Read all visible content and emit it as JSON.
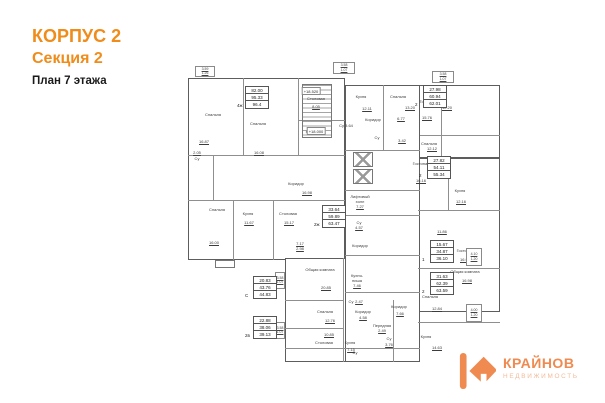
{
  "header": {
    "building": "КОРПУС 2",
    "section": "Секция 2",
    "plan_title": "План 7 этажа"
  },
  "logo": {
    "name": "КРАЙНОВ",
    "subtitle": "НЕДВИЖИМОСТЬ"
  },
  "colors": {
    "accent_orange": "#ef8c1a",
    "logo_orange": "#ef8a50",
    "logo_light": "#f3bb98",
    "wall_gray": "#5d5d5d"
  },
  "plan": {
    "elevations": [
      {
        "t": "+18.520",
        "x": 128,
        "y": 31
      },
      {
        "t": "+18.000",
        "x": 133,
        "y": 71
      }
    ],
    "apartments": [
      {
        "x": 62,
        "y": 26,
        "type": "4ж",
        "rows": [
          "82.00",
          "95.33",
          "96.4"
        ]
      },
      {
        "x": 240,
        "y": 25,
        "type": "2",
        "rows": [
          "27.98",
          "60.94",
          "62.01"
        ]
      },
      {
        "x": 244,
        "y": 96,
        "type": "2",
        "rows": [
          "27.82",
          "54.11",
          "55.34"
        ]
      },
      {
        "x": 247,
        "y": 180,
        "type": "1",
        "rows": [
          "15.67",
          "34.87",
          "36.10"
        ]
      },
      {
        "x": 247,
        "y": 212,
        "type": "2",
        "rows": [
          "31.63",
          "62.39",
          "63.59"
        ]
      },
      {
        "x": 139,
        "y": 145,
        "type": "2ж",
        "rows": [
          "33.64",
          "59.89",
          "63.47"
        ]
      },
      {
        "x": 70,
        "y": 216,
        "type": "С",
        "rows": [
          "20.83",
          "43.76",
          "44.83"
        ]
      },
      {
        "x": 70,
        "y": 256,
        "type": "2в",
        "rows": [
          "22.88",
          "38.06",
          "39.13"
        ]
      }
    ],
    "balconies": [
      {
        "x": 12,
        "y": 6,
        "w": 20,
        "h": 11,
        "a": "3.59",
        "b": "1.26"
      },
      {
        "x": 150,
        "y": 2,
        "w": 22,
        "h": 12,
        "a": "3.58",
        "b": "1.07"
      },
      {
        "x": 249,
        "y": 11,
        "w": 22,
        "h": 12,
        "a": "3.58",
        "b": "1.07"
      },
      {
        "x": 283,
        "y": 188,
        "w": 16,
        "h": 18,
        "a": "4.10",
        "b": "1.20"
      },
      {
        "x": 283,
        "y": 244,
        "w": 16,
        "h": 18,
        "a": "4.00",
        "b": "1.20"
      },
      {
        "x": 92,
        "y": 212,
        "w": 10,
        "h": 17,
        "a": "3.58",
        "b": "1.07"
      },
      {
        "x": 92,
        "y": 262,
        "w": 10,
        "h": 17,
        "a": "3.58",
        "b": "1.07"
      }
    ],
    "labels": [
      {
        "t": "Спальня",
        "x": 30,
        "y": 55
      },
      {
        "t": "16.87",
        "x": 21,
        "y": 82
      },
      {
        "t": "Спальня",
        "x": 75,
        "y": 64
      },
      {
        "t": "16.08",
        "x": 76,
        "y": 93
      },
      {
        "t": "Столовая",
        "x": 133,
        "y": 39
      },
      {
        "t": "8.05",
        "x": 133,
        "y": 47
      },
      {
        "t": "Кухня",
        "x": 128,
        "y": 72
      },
      {
        "t": "2.05",
        "x": 14,
        "y": 93
      },
      {
        "t": "Су",
        "x": 14,
        "y": 99
      },
      {
        "t": "Коридор",
        "x": 113,
        "y": 124
      },
      {
        "t": "16.98",
        "x": 124,
        "y": 133
      },
      {
        "t": "Спальня",
        "x": 34,
        "y": 150
      },
      {
        "t": "16.00",
        "x": 31,
        "y": 183
      },
      {
        "t": "Кухня",
        "x": 65,
        "y": 154
      },
      {
        "t": "11.67",
        "x": 66,
        "y": 163
      },
      {
        "t": "Столовая",
        "x": 105,
        "y": 154
      },
      {
        "t": "15.17",
        "x": 106,
        "y": 163
      },
      {
        "t": "7.17",
        "x": 117,
        "y": 184
      },
      {
        "t": "2.98",
        "x": 117,
        "y": 189
      },
      {
        "t": "Кухня",
        "x": 178,
        "y": 37
      },
      {
        "t": "12.11",
        "x": 184,
        "y": 49
      },
      {
        "t": "Спальня",
        "x": 215,
        "y": 37
      },
      {
        "t": "13.20",
        "x": 227,
        "y": 48
      },
      {
        "t": "12.20",
        "x": 264,
        "y": 48
      },
      {
        "t": "Коридор",
        "x": 190,
        "y": 60
      },
      {
        "t": "Су 3.64",
        "x": 163,
        "y": 66
      },
      {
        "t": "6.77",
        "x": 218,
        "y": 59
      },
      {
        "t": "Гостиная",
        "x": 245,
        "y": 42
      },
      {
        "t": "15.76",
        "x": 244,
        "y": 58
      },
      {
        "t": "Су",
        "x": 194,
        "y": 78
      },
      {
        "t": "3.42",
        "x": 219,
        "y": 81
      },
      {
        "t": "Спальня",
        "x": 246,
        "y": 84
      },
      {
        "t": "12.12",
        "x": 249,
        "y": 89
      },
      {
        "t": "Гостиная",
        "x": 238,
        "y": 104
      },
      {
        "t": "16.16",
        "x": 238,
        "y": 121
      },
      {
        "t": "Кухня",
        "x": 277,
        "y": 131
      },
      {
        "t": "12.16",
        "x": 278,
        "y": 142
      },
      {
        "t": "11.86",
        "x": 259,
        "y": 172
      },
      {
        "t": "Гостиная",
        "x": 282,
        "y": 191
      },
      {
        "t": "16.96",
        "x": 282,
        "y": 200
      },
      {
        "t": "Общая комната",
        "x": 282,
        "y": 212
      },
      {
        "t": "16.98",
        "x": 284,
        "y": 221
      },
      {
        "t": "Спальня",
        "x": 247,
        "y": 237
      },
      {
        "t": "12.84",
        "x": 254,
        "y": 249
      },
      {
        "t": "Кухня",
        "x": 243,
        "y": 277
      },
      {
        "t": "14.63",
        "x": 254,
        "y": 288
      },
      {
        "t": "Лифтовый",
        "x": 177,
        "y": 137
      },
      {
        "t": "холл",
        "x": 177,
        "y": 142
      },
      {
        "t": "7.27",
        "x": 177,
        "y": 147
      },
      {
        "t": "Су",
        "x": 176,
        "y": 163
      },
      {
        "t": "4.57",
        "x": 176,
        "y": 168
      },
      {
        "t": "Коридор",
        "x": 177,
        "y": 186
      },
      {
        "t": "Общая комната",
        "x": 137,
        "y": 210
      },
      {
        "t": "20.85",
        "x": 143,
        "y": 228
      },
      {
        "t": "Кухня-",
        "x": 174,
        "y": 216
      },
      {
        "t": "ниша",
        "x": 174,
        "y": 221
      },
      {
        "t": "7.46",
        "x": 174,
        "y": 226
      },
      {
        "t": "Су",
        "x": 168,
        "y": 242
      },
      {
        "t": "2.47",
        "x": 176,
        "y": 242
      },
      {
        "t": "Коридор",
        "x": 180,
        "y": 252
      },
      {
        "t": "4.58",
        "x": 180,
        "y": 258
      },
      {
        "t": "Спальня",
        "x": 142,
        "y": 252
      },
      {
        "t": "12.76",
        "x": 147,
        "y": 261
      },
      {
        "t": "Коридор",
        "x": 216,
        "y": 247
      },
      {
        "t": "7.66",
        "x": 217,
        "y": 254
      },
      {
        "t": "Передняя",
        "x": 199,
        "y": 266
      },
      {
        "t": "2.49",
        "x": 199,
        "y": 271
      },
      {
        "t": "10.85",
        "x": 146,
        "y": 275
      },
      {
        "t": "Столовая",
        "x": 141,
        "y": 283
      },
      {
        "t": "Кухня",
        "x": 167,
        "y": 283
      },
      {
        "t": "7.15",
        "x": 168,
        "y": 290
      },
      {
        "t": "Су",
        "x": 206,
        "y": 279
      },
      {
        "t": "3.76",
        "x": 206,
        "y": 285
      },
      {
        "t": "Су",
        "x": 172,
        "y": 293
      }
    ]
  }
}
